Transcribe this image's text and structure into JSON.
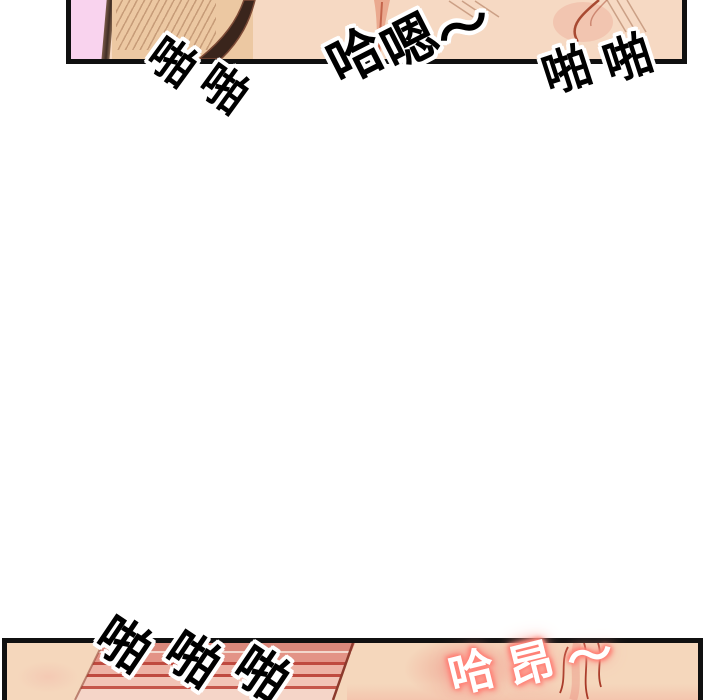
{
  "meta": {
    "content_type": "webtoon comic strip fragment",
    "language": "Chinese"
  },
  "colors": {
    "paper": "#ffffff",
    "ink": "#101010",
    "wall-pink": "#f9d3ee",
    "skin-tan": "#ecc8a2",
    "skin-light": "#f6d9c3",
    "skin-bottom": "#f5d7bc",
    "shadow-brown": "#3a251c",
    "crease-pink": "#eaa98f",
    "crease-red": "#c4654c",
    "art-line-red": "#a84a32",
    "hatch-brown": "rgba(139,84,54,0.45)",
    "stripe-salmon": "#da887b",
    "stripe-salmon2": "#e39386",
    "stripe-red": "#bf4a3f",
    "stripe-red2": "#c5564a",
    "stripe-pink": "#edb2a4",
    "stripe-pink2": "#f2c4b6",
    "stripe-pale": "#f5d5c8",
    "stripe-light": "#f3d7cc",
    "stripe-edge": "#8c3a2c",
    "sfx-ink": "#000000",
    "sfx-outline": "#ffffff",
    "glow-red": "#ff7d72"
  },
  "sfx": [
    {
      "name": "sfx-top-left-slap",
      "text": "啪啪",
      "style": "outline",
      "x": 172,
      "y": 62,
      "dx": 52,
      "dy": 27,
      "rotate": 36,
      "size": 46
    },
    {
      "name": "sfx-top-moan",
      "text": "哈嗯～",
      "style": "outline",
      "x": 356,
      "y": 57,
      "dx": 54,
      "dy": -14,
      "rotate": -27,
      "size": 54
    },
    {
      "name": "sfx-top-right-slap",
      "text": "啪啪",
      "style": "outline",
      "x": 567,
      "y": 71,
      "dx": 61,
      "dy": -12,
      "rotate": -18,
      "size": 48
    },
    {
      "name": "sfx-bottom-slap",
      "text": "啪啪啪",
      "style": "outline",
      "x": 123,
      "y": 645,
      "dx": 69,
      "dy": 15,
      "rotate": 34,
      "size": 52
    },
    {
      "name": "sfx-bottom-moan",
      "text": "哈昂～",
      "style": "glow",
      "x": 472,
      "y": 672,
      "dx": 59,
      "dy": -8,
      "rotate": -14,
      "size": 46
    }
  ]
}
